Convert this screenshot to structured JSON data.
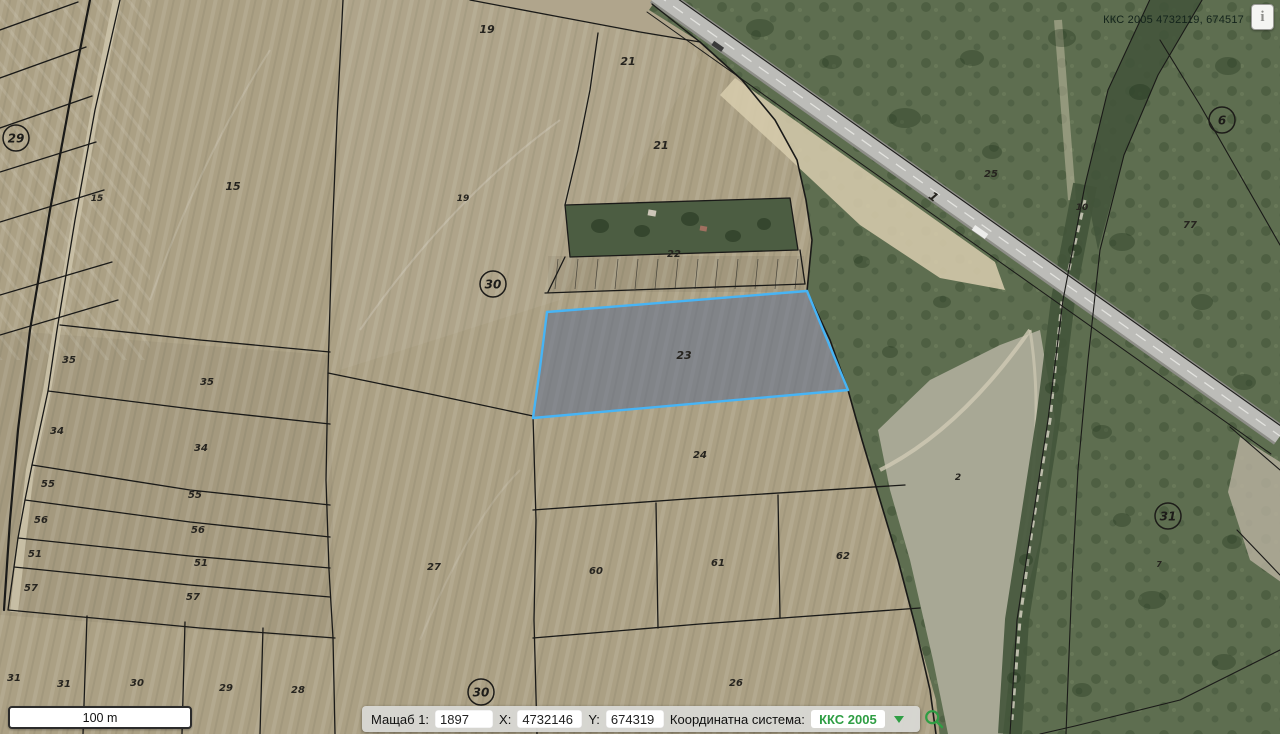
{
  "header": {
    "coords_readout": "ККС 2005 4732119, 674517",
    "info_button_glyph": "i"
  },
  "scalebar": {
    "label": "100 m"
  },
  "toolbar": {
    "scale_label": "Мащаб 1:",
    "scale_value": "1897",
    "x_label": "X:",
    "x_value": "4732146",
    "y_label": "Y:",
    "y_value": "674319",
    "crs_label": "Координатна система:",
    "crs_value": "ККС 2005"
  },
  "colors": {
    "accent_green": "#2f9e44",
    "farmland": "#aba084",
    "scrub_green": "#5e6e50",
    "selection_outline": "#47b4f5",
    "selection_fill": "rgba(88,104,140,0.5)"
  },
  "map": {
    "selected_parcel": {
      "id": "23",
      "points": "547,312 807,291 848,390 533,418 540,368"
    },
    "parcel_labels": [
      {
        "id": "15",
        "x": 97,
        "y": 201,
        "s": 9
      },
      {
        "id": "15",
        "x": 233,
        "y": 190,
        "s": 11
      },
      {
        "id": "19",
        "x": 487,
        "y": 33,
        "s": 11
      },
      {
        "id": "19",
        "x": 463,
        "y": 201,
        "s": 9
      },
      {
        "id": "21",
        "x": 628,
        "y": 65,
        "s": 11
      },
      {
        "id": "21",
        "x": 661,
        "y": 149,
        "s": 11
      },
      {
        "id": "22",
        "x": 674,
        "y": 257,
        "s": 10
      },
      {
        "id": "23",
        "x": 684,
        "y": 359,
        "s": 11
      },
      {
        "id": "24",
        "x": 700,
        "y": 458,
        "s": 10
      },
      {
        "id": "26",
        "x": 736,
        "y": 686,
        "s": 10
      },
      {
        "id": "27",
        "x": 434,
        "y": 570,
        "s": 10
      },
      {
        "id": "60",
        "x": 596,
        "y": 574,
        "s": 10
      },
      {
        "id": "61",
        "x": 718,
        "y": 566,
        "s": 10
      },
      {
        "id": "62",
        "x": 843,
        "y": 559,
        "s": 10
      },
      {
        "id": "35",
        "x": 69,
        "y": 363,
        "s": 10
      },
      {
        "id": "35",
        "x": 207,
        "y": 385,
        "s": 10
      },
      {
        "id": "34",
        "x": 57,
        "y": 434,
        "s": 10
      },
      {
        "id": "34",
        "x": 201,
        "y": 451,
        "s": 10
      },
      {
        "id": "55",
        "x": 48,
        "y": 487,
        "s": 10
      },
      {
        "id": "55",
        "x": 195,
        "y": 498,
        "s": 10
      },
      {
        "id": "56",
        "x": 41,
        "y": 523,
        "s": 10
      },
      {
        "id": "56",
        "x": 198,
        "y": 533,
        "s": 10
      },
      {
        "id": "51",
        "x": 35,
        "y": 557,
        "s": 10
      },
      {
        "id": "51",
        "x": 201,
        "y": 566,
        "s": 10
      },
      {
        "id": "57",
        "x": 31,
        "y": 591,
        "s": 10
      },
      {
        "id": "57",
        "x": 193,
        "y": 600,
        "s": 10
      },
      {
        "id": "31",
        "x": 14,
        "y": 681,
        "s": 10
      },
      {
        "id": "31",
        "x": 64,
        "y": 687,
        "s": 10
      },
      {
        "id": "30",
        "x": 137,
        "y": 686,
        "s": 10
      },
      {
        "id": "29",
        "x": 226,
        "y": 691,
        "s": 10
      },
      {
        "id": "28",
        "x": 298,
        "y": 693,
        "s": 10
      },
      {
        "id": "25",
        "x": 991,
        "y": 177,
        "s": 10
      },
      {
        "id": "10",
        "x": 1082,
        "y": 210,
        "s": 9
      },
      {
        "id": "77",
        "x": 1190,
        "y": 228,
        "s": 10
      },
      {
        "id": "2",
        "x": 958,
        "y": 480,
        "s": 9
      },
      {
        "id": "7",
        "x": 1159,
        "y": 567,
        "s": 8
      },
      {
        "id": "1",
        "x": 931,
        "y": 200,
        "s": 12,
        "rot": 38
      }
    ],
    "circled_labels": [
      {
        "id": "29",
        "x": 16,
        "y": 138
      },
      {
        "id": "30",
        "x": 493,
        "y": 284
      },
      {
        "id": "30",
        "x": 481,
        "y": 692
      },
      {
        "id": "6",
        "x": 1222,
        "y": 120
      },
      {
        "id": "31",
        "x": 1168,
        "y": 516
      }
    ]
  }
}
